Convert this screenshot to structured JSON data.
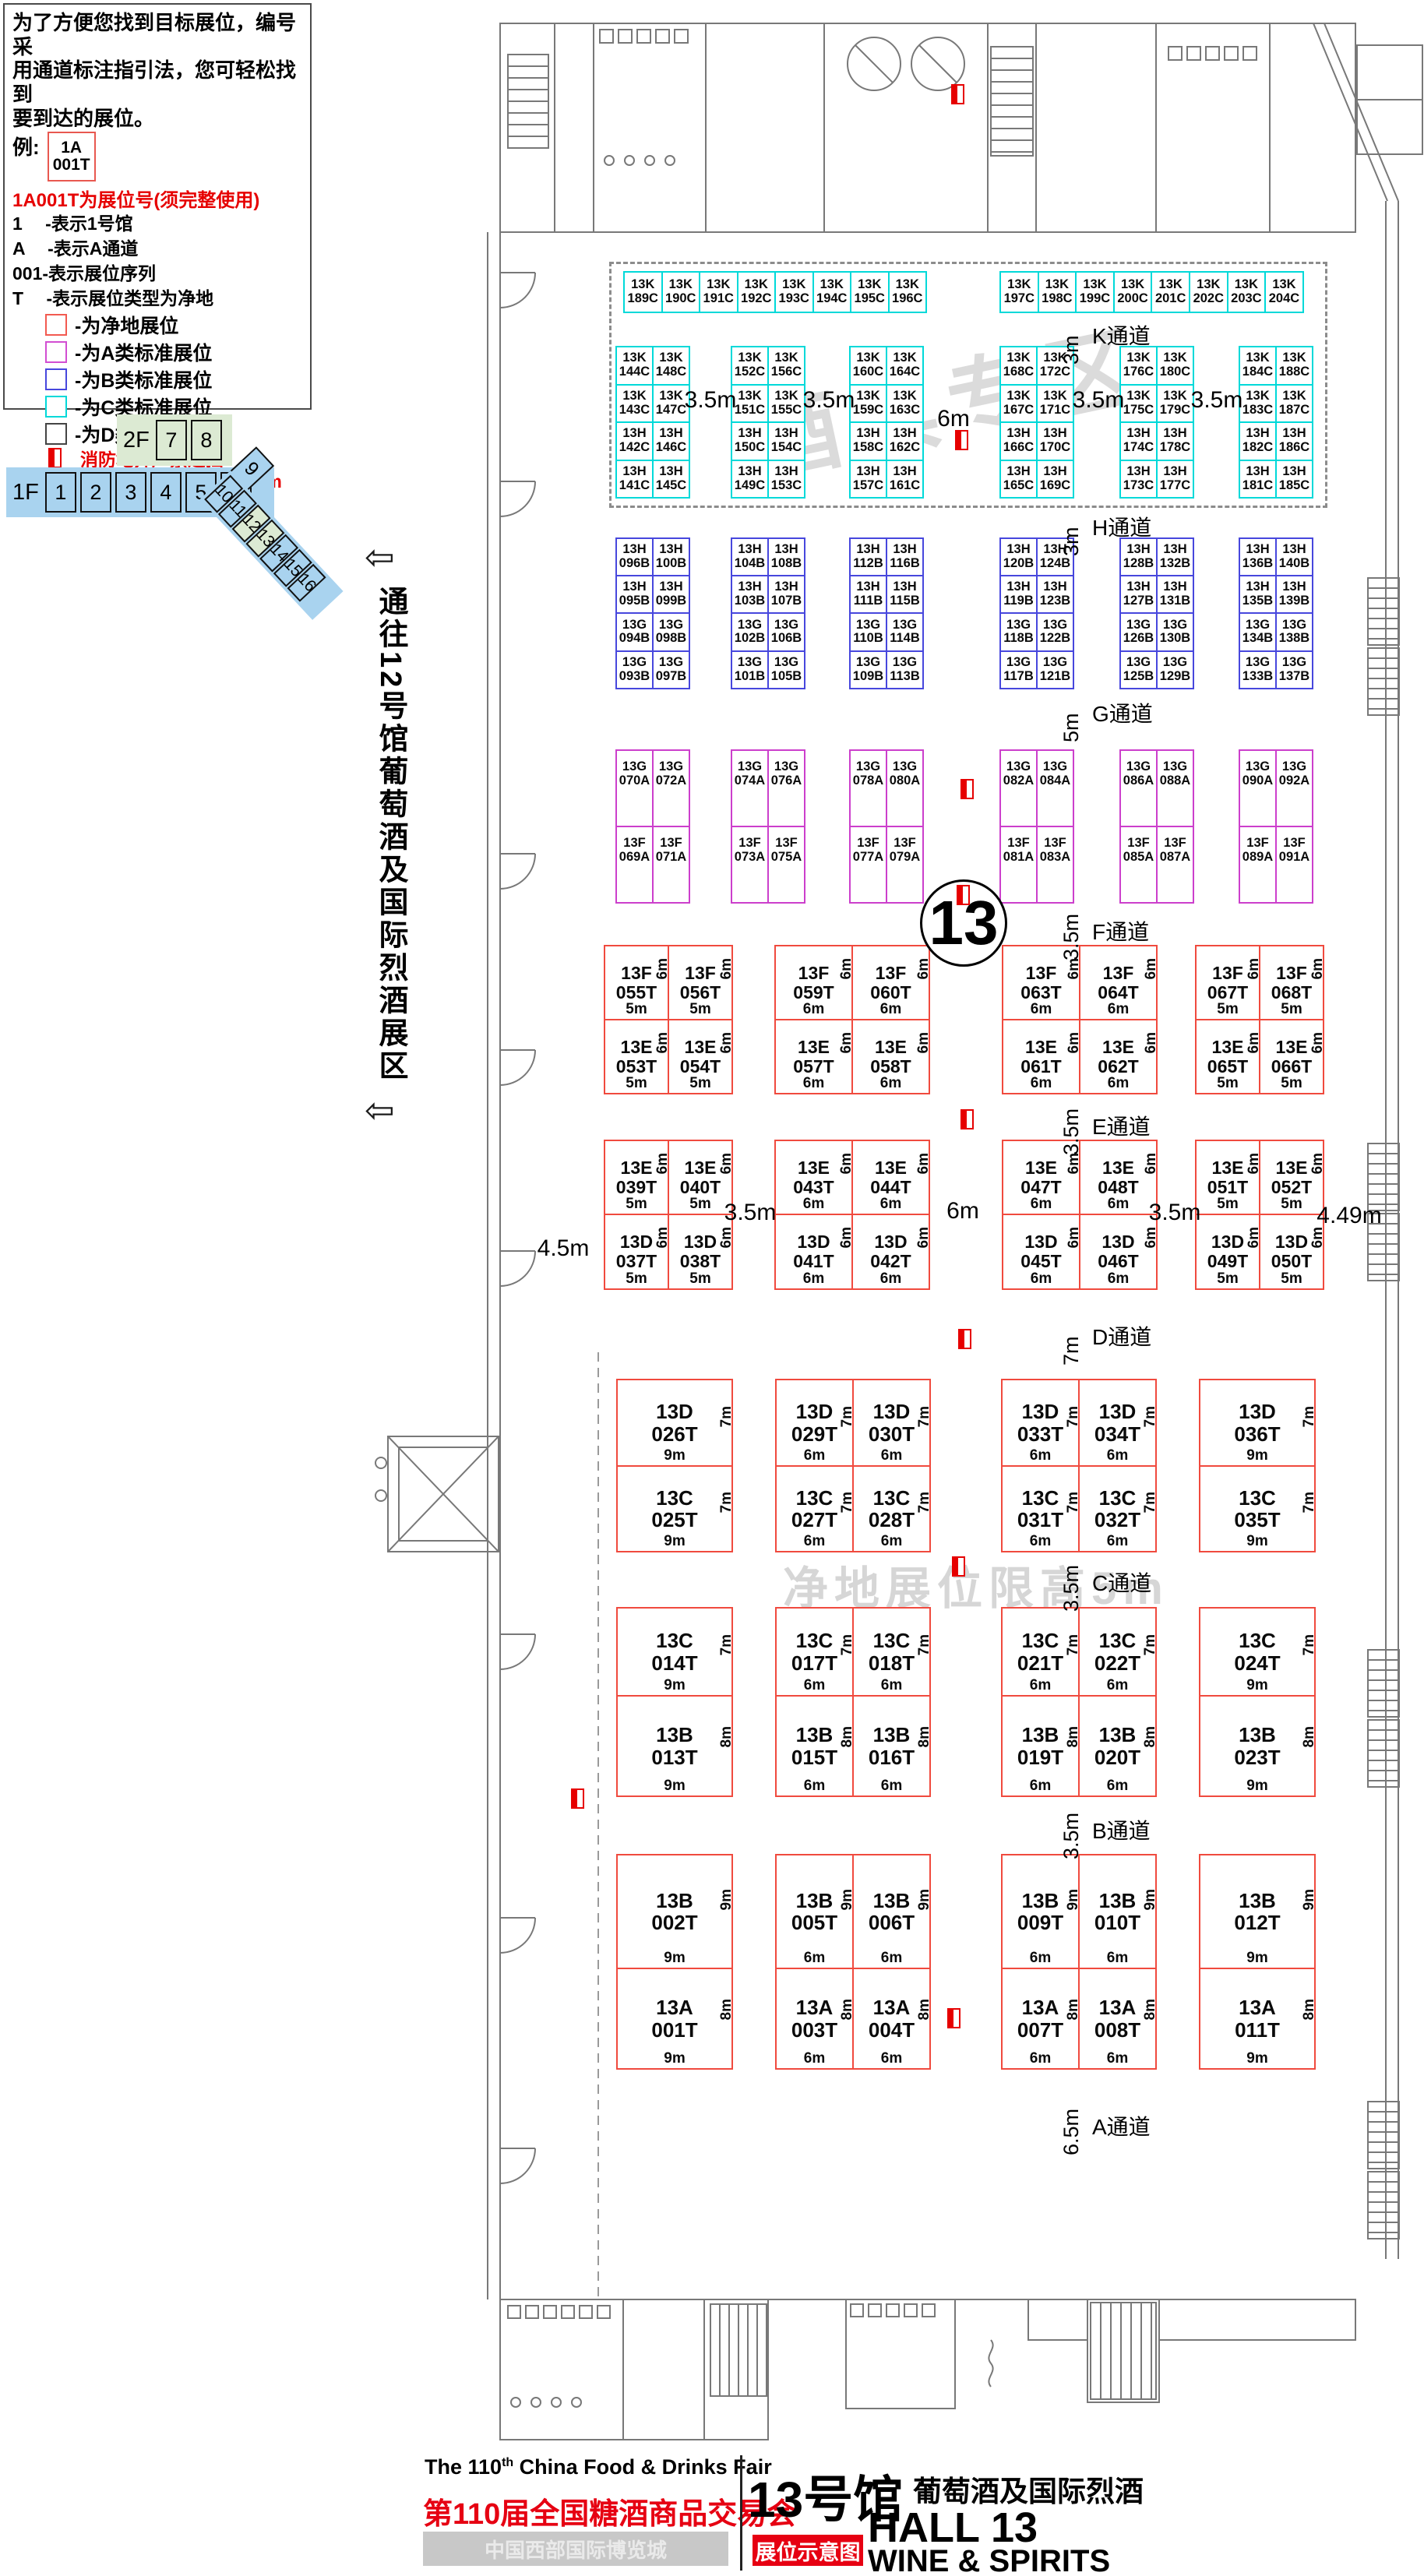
{
  "legend": {
    "intro_lines": [
      "为了方便您找到目标展位，编号采",
      "用通道标注指引法，您可轻松找到",
      "要到达的展位。"
    ],
    "example_label": "例:",
    "example_booth": [
      "1A",
      "001T"
    ],
    "heading": "1A001T为展位号(须完整使用)",
    "decode_lines": [
      "1　 -表示1号馆",
      "A　 -表示A通道",
      "001-表示展位序列",
      "T　 -表示展位类型为净地"
    ],
    "items": [
      {
        "swatch": "#f25a50",
        "label": "-为净地展位"
      },
      {
        "swatch": "#d24ed2",
        "label": "-为A类标准展位"
      },
      {
        "swatch": "#4747dd",
        "label": "-为B类标准展位"
      },
      {
        "swatch": "#00d9d9",
        "label": "-为C类标准展位"
      },
      {
        "swatch": "#444444",
        "label": "-为D类标准展位"
      }
    ],
    "fire_note": "消防地井严禁遮挡",
    "pillar_note": "展位内立柱 直径均为1.5m"
  },
  "minimap": {
    "floor2_label": "2F",
    "floor2_halls": [
      "7",
      "8"
    ],
    "floor1_label": "1F",
    "floor1_halls": [
      "1",
      "2",
      "3",
      "4",
      "5",
      "6"
    ],
    "rotated_hall": "9",
    "diagonal_halls": [
      "10",
      "11",
      "12",
      "13",
      "14",
      "15",
      "16"
    ],
    "highlighted_halls": [
      "12",
      "13"
    ]
  },
  "corridor": {
    "text": "通往12号馆葡萄酒及国际烈酒展区",
    "arrow": "⇦"
  },
  "watermarks": {
    "zone": "酒具专区",
    "height_limit": "净地展位限高5m"
  },
  "hall_circle": "13",
  "aisles": [
    {
      "name": "K通道",
      "dim": "3m"
    },
    {
      "name": "H通道",
      "dim": "3m"
    },
    {
      "name": "G通道",
      "dim": "5m"
    },
    {
      "name": "F通道",
      "dim": "3.5m"
    },
    {
      "name": "E通道",
      "dim": "3.5m"
    },
    {
      "name": "D通道",
      "dim": "7m"
    },
    {
      "name": "C通道",
      "dim": "3.5m"
    },
    {
      "name": "B通道",
      "dim": "3.5m"
    },
    {
      "name": "A通道",
      "dim": "6.5m"
    }
  ],
  "gap_labels": {
    "k": [
      "3.5m",
      "3.5m",
      "6m",
      "3.5m",
      "3.5m"
    ],
    "ed": [
      "4.5m",
      "3.5m",
      "6m",
      "3.5m",
      "4.49m"
    ]
  },
  "bands": {
    "k_row": [
      "13K 189C",
      "13K 190C",
      "13K 191C",
      "13K 192C",
      "13K 193C",
      "13K 194C",
      "13K 195C",
      "13K 196C",
      "13K 197C",
      "13K 198C",
      "13K 199C",
      "13K 200C",
      "13K 201C",
      "13K 202C",
      "13K 203C",
      "13K 204C"
    ],
    "k_grid": [
      [
        [
          "13K 144C",
          "13K 148C"
        ],
        [
          "13K 143C",
          "13K 147C"
        ],
        [
          "13H 142C",
          "13H 146C"
        ],
        [
          "13H 141C",
          "13H 145C"
        ]
      ],
      [
        [
          "13K 152C",
          "13K 156C"
        ],
        [
          "13K 151C",
          "13K 155C"
        ],
        [
          "13H 150C",
          "13H 154C"
        ],
        [
          "13H 149C",
          "13H 153C"
        ]
      ],
      [
        [
          "13K 160C",
          "13K 164C"
        ],
        [
          "13K 159C",
          "13K 163C"
        ],
        [
          "13H 158C",
          "13H 162C"
        ],
        [
          "13H 157C",
          "13H 161C"
        ]
      ],
      [
        [
          "13K 168C",
          "13K 172C"
        ],
        [
          "13K 167C",
          "13K 171C"
        ],
        [
          "13H 166C",
          "13H 170C"
        ],
        [
          "13H 165C",
          "13H 169C"
        ]
      ],
      [
        [
          "13K 176C",
          "13K 180C"
        ],
        [
          "13K 175C",
          "13K 179C"
        ],
        [
          "13H 174C",
          "13H 178C"
        ],
        [
          "13H 173C",
          "13H 177C"
        ]
      ],
      [
        [
          "13K 184C",
          "13K 188C"
        ],
        [
          "13K 183C",
          "13K 187C"
        ],
        [
          "13H 182C",
          "13H 186C"
        ],
        [
          "13H 181C",
          "13H 185C"
        ]
      ]
    ],
    "h_grid": [
      [
        [
          "13H 096B",
          "13H 100B"
        ],
        [
          "13H 095B",
          "13H 099B"
        ],
        [
          "13G 094B",
          "13G 098B"
        ],
        [
          "13G 093B",
          "13G 097B"
        ]
      ],
      [
        [
          "13H 104B",
          "13H 108B"
        ],
        [
          "13H 103B",
          "13H 107B"
        ],
        [
          "13G 102B",
          "13G 106B"
        ],
        [
          "13G 101B",
          "13G 105B"
        ]
      ],
      [
        [
          "13H 112B",
          "13H 116B"
        ],
        [
          "13H 111B",
          "13H 115B"
        ],
        [
          "13G 110B",
          "13G 114B"
        ],
        [
          "13G 109B",
          "13G 113B"
        ]
      ],
      [
        [
          "13H 120B",
          "13H 124B"
        ],
        [
          "13H 119B",
          "13H 123B"
        ],
        [
          "13G 118B",
          "13G 122B"
        ],
        [
          "13G 117B",
          "13G 121B"
        ]
      ],
      [
        [
          "13H 128B",
          "13H 132B"
        ],
        [
          "13H 127B",
          "13H 131B"
        ],
        [
          "13G 126B",
          "13G 130B"
        ],
        [
          "13G 125B",
          "13G 129B"
        ]
      ],
      [
        [
          "13H 136B",
          "13H 140B"
        ],
        [
          "13H 135B",
          "13H 139B"
        ],
        [
          "13G 134B",
          "13G 138B"
        ],
        [
          "13G 133B",
          "13G 137B"
        ]
      ]
    ],
    "gf_grid": [
      [
        [
          "13G 070A",
          "13G 072A"
        ],
        [
          "13F 069A",
          "13F 071A"
        ]
      ],
      [
        [
          "13G 074A",
          "13G 076A"
        ],
        [
          "13F 073A",
          "13F 075A"
        ]
      ],
      [
        [
          "13G 078A",
          "13G 080A"
        ],
        [
          "13F 077A",
          "13F 079A"
        ]
      ],
      [
        [
          "13G 082A",
          "13G 084A"
        ],
        [
          "13F 081A",
          "13F 083A"
        ]
      ],
      [
        [
          "13G 086A",
          "13G 088A"
        ],
        [
          "13F 085A",
          "13F 087A"
        ]
      ],
      [
        [
          "13G 090A",
          "13G 092A"
        ],
        [
          "13F 089A",
          "13F 091A"
        ]
      ]
    ],
    "fe": [
      [
        [
          "13F 055T 5m 6m",
          "13F 056T 5m 6m"
        ],
        [
          "13E 053T 5m 6m",
          "13E 054T 5m 6m"
        ]
      ],
      [
        [
          "13F 059T 6m 6m",
          "13F 060T 6m 6m"
        ],
        [
          "13E 057T 6m 6m",
          "13E 058T 6m 6m"
        ]
      ],
      [
        [
          "13F 063T 6m 6m",
          "13F 064T 6m 6m"
        ],
        [
          "13E 061T 6m 6m",
          "13E 062T 6m 6m"
        ]
      ],
      [
        [
          "13F 067T 5m 6m",
          "13F 068T 5m 6m"
        ],
        [
          "13E 065T 5m 6m",
          "13E 066T 5m 6m"
        ]
      ]
    ],
    "ed": [
      [
        [
          "13E 039T 5m 6m",
          "13E 040T 5m 6m"
        ],
        [
          "13D 037T 5m 6m",
          "13D 038T 5m 6m"
        ]
      ],
      [
        [
          "13E 043T 6m 6m",
          "13E 044T 6m 6m"
        ],
        [
          "13D 041T 6m 6m",
          "13D 042T 6m 6m"
        ]
      ],
      [
        [
          "13E 047T 6m 6m",
          "13E 048T 6m 6m"
        ],
        [
          "13D 045T 6m 6m",
          "13D 046T 6m 6m"
        ]
      ],
      [
        [
          "13E 051T 5m 6m",
          "13E 052T 5m 6m"
        ],
        [
          "13D 049T 5m 6m",
          "13D 050T 5m 6m"
        ]
      ]
    ],
    "dc": [
      [
        [
          "13D 026T 9m 7m"
        ],
        [
          "13C 025T 9m 7m"
        ]
      ],
      [
        [
          "13D 029T 6m 7m",
          "13D 030T 6m 7m"
        ],
        [
          "13C 027T 6m 7m",
          "13C 028T 6m 7m"
        ]
      ],
      [
        [
          "13D 033T 6m 7m",
          "13D 034T 6m 7m"
        ],
        [
          "13C 031T 6m 7m",
          "13C 032T 6m 7m"
        ]
      ],
      [
        [
          "13D 036T 9m 7m"
        ],
        [
          "13C 035T 9m 7m"
        ]
      ]
    ],
    "cb": [
      [
        [
          "13C 014T 9m 7m"
        ],
        [
          "13B 013T 9m 8m"
        ]
      ],
      [
        [
          "13C 017T 6m 7m",
          "13C 018T 6m 7m"
        ],
        [
          "13B 015T 6m 8m",
          "13B 016T 6m 8m"
        ]
      ],
      [
        [
          "13C 021T 6m 7m",
          "13C 022T 6m 7m"
        ],
        [
          "13B 019T 6m 8m",
          "13B 020T 6m 8m"
        ]
      ],
      [
        [
          "13C 024T 9m 7m"
        ],
        [
          "13B 023T 9m 8m"
        ]
      ]
    ],
    "ba": [
      [
        [
          "13B 002T 9m 9m"
        ],
        [
          "13A 001T 9m 8m"
        ]
      ],
      [
        [
          "13B 005T 6m 9m",
          "13B 006T 6m 9m"
        ],
        [
          "13A 003T 6m 8m",
          "13A 004T 6m 8m"
        ]
      ],
      [
        [
          "13B 009T 6m 9m",
          "13B 010T 6m 9m"
        ],
        [
          "13A 007T 6m 8m",
          "13A 008T 6m 8m"
        ]
      ],
      [
        [
          "13B 012T 9m 9m"
        ],
        [
          "13A 011T 9m 8m"
        ]
      ]
    ]
  },
  "footer": {
    "en_title_prefix": "The 110",
    "en_title_sup": "th",
    "en_title_suffix": " China Food & Drinks Fair",
    "cn_title": "第110届全国糖酒商品交易会",
    "venue": "中国西部国际博览城",
    "hall_cn": "13号馆",
    "hall_category_cn": "葡萄酒及国际烈酒",
    "hall_en": "HALL 13",
    "hall_category_en": "WINE & SPIRITS",
    "tag": "展位示意图"
  }
}
